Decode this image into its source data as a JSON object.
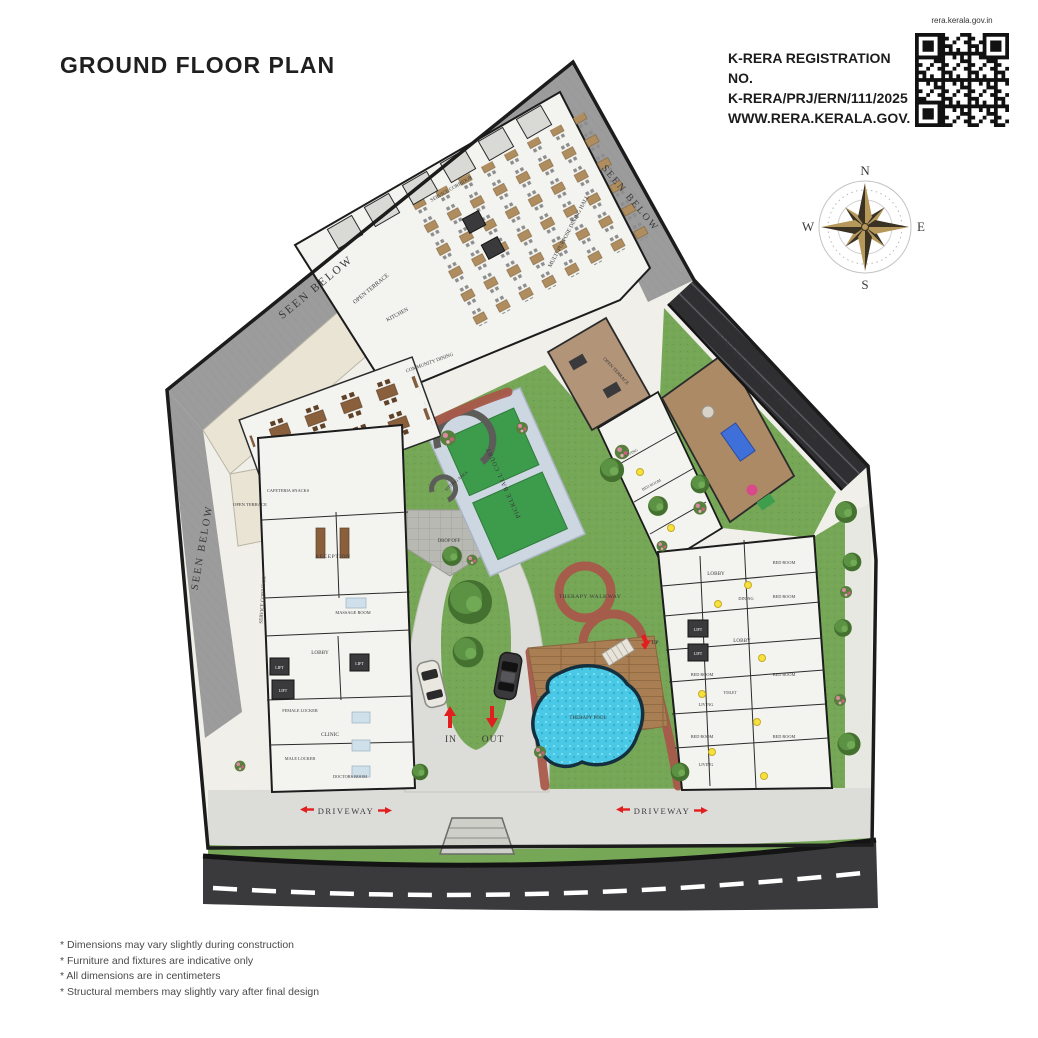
{
  "header": {
    "title": "GROUND FLOOR PLAN"
  },
  "rera": {
    "line1": "K-RERA REGISTRATION NO.",
    "line2": "K-RERA/PRJ/ERN/111/2025",
    "line3": "WWW.RERA.KERALA.GOV.IN",
    "qr_caption": "rera.kerala.gov.in"
  },
  "compass": {
    "north": "N",
    "east": "E",
    "south": "S",
    "west": "W"
  },
  "plan": {
    "labels": {
      "seen_below": "SEEN BELOW",
      "open_terrace": "OPEN TERRACE",
      "service_corridor": "SERVICE CORRIDOR",
      "ramp": "RAMP DN TO LOWER GROUND FLOOR",
      "multi_purpose_hall": "MULTI PURPOSE DINING HALL",
      "community_dining": "COMMUNITY DINING",
      "kitchen": "KITCHEN",
      "cafeteria": "CAFETERIA SNACKS",
      "reception": "RECEPTION",
      "lobby": "LOBBY",
      "lift": "LIFT",
      "massage_room": "MASSAGE ROOM",
      "female_locker": "FEMALE LOCKER",
      "male_locker": "MALE LOCKER",
      "clinic": "CLINIC",
      "doctors_room": "DOCTORS ROOM",
      "bed_room": "BED ROOM",
      "living": "LIVING",
      "dining": "DINING",
      "toilet": "TOILET",
      "pickle_court": "PICKLE BALL COURT",
      "sitting_area": "SITTING AREA",
      "therapy_walkway": "THERAPY WALKWAY",
      "therapy_pool": "THERAPY POOL",
      "drop_off": "DROP OFF",
      "up": "UP",
      "in": "IN",
      "out": "OUT",
      "driveway": "DRIVEWAY",
      "road": "ROAD"
    },
    "colors": {
      "grass": "#76a757",
      "court_green": "#3d9b4c",
      "court_frame": "#cdd7e2",
      "walkway_red": "#a8584a",
      "pool_blue": "#49c9e6",
      "deck_brown": "#a97e52",
      "roof_gray": "#9c9c9c",
      "ramp_dark": "#2f2f31",
      "road_dark": "#3a3a3c",
      "compass_gold": "#b5985a",
      "arrow_red": "#e21f1f",
      "unit_marker_yellow": "#f5e23a"
    }
  },
  "footnotes": [
    "* Dimensions may vary slightly during construction",
    "* Furniture and fixtures are indicative only",
    "* All dimensions are in centimeters",
    "* Structural members may slightly vary after final design"
  ]
}
